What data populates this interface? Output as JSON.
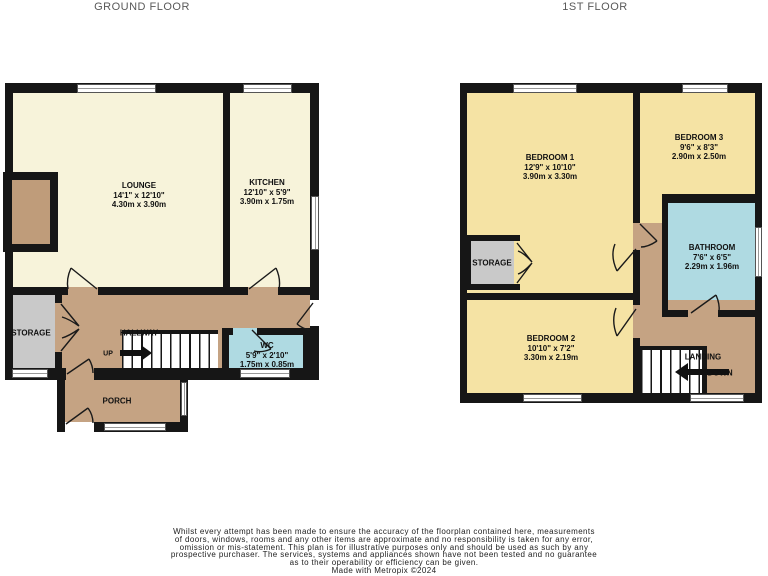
{
  "titles": {
    "ground": "GROUND FLOOR",
    "first": "1ST FLOOR"
  },
  "labels": {
    "up": "UP",
    "down": "DOWN"
  },
  "rooms": {
    "lounge": {
      "name": "LOUNGE",
      "imperial": "14'1\" x 12'10\"",
      "metric": "4.30m x 3.90m"
    },
    "kitchen": {
      "name": "KITCHEN",
      "imperial": "12'10\" x 5'9\"",
      "metric": "3.90m x 1.75m"
    },
    "storage_gf": {
      "name": "STORAGE"
    },
    "hallway": {
      "name": "HALLWAY"
    },
    "wc": {
      "name": "WC",
      "imperial": "5'9\" x 2'10\"",
      "metric": "1.75m x 0.85m"
    },
    "porch": {
      "name": "PORCH"
    },
    "bedroom1": {
      "name": "BEDROOM 1",
      "imperial": "12'9\" x 10'10\"",
      "metric": "3.90m x 3.30m"
    },
    "bedroom2": {
      "name": "BEDROOM 2",
      "imperial": "10'10\" x 7'2\"",
      "metric": "3.30m x 2.19m"
    },
    "bedroom3": {
      "name": "BEDROOM 3",
      "imperial": "9'6\" x 8'3\"",
      "metric": "2.90m x 2.50m"
    },
    "bathroom": {
      "name": "BATHROOM",
      "imperial": "7'6\" x 6'5\"",
      "metric": "2.29m x 1.96m"
    },
    "storage_ff": {
      "name": "STORAGE"
    },
    "landing": {
      "name": "LANDING"
    }
  },
  "footer": {
    "line1": "Whilst every attempt has been made to ensure the accuracy of the floorplan contained here, measurements",
    "line2": "of doors, windows, rooms and any other items are approximate and no responsibility is taken for any error,",
    "line3": "omission or mis-statement. This plan is for illustrative purposes only and should be used as such by any",
    "line4": "prospective purchaser. The services, systems and appliances shown have not been tested and no guarantee",
    "line5": "as to their operability or efficiency can be given.",
    "credit": "Made with Metropix ©2024"
  },
  "colors": {
    "wall": "#161616",
    "cream": "#f7f3da",
    "yellow": "#f5e3a4",
    "tan": "#c5a383",
    "tan2": "#bf9c7a",
    "gray": "#c9c9c9",
    "blue": "#afdae2"
  }
}
